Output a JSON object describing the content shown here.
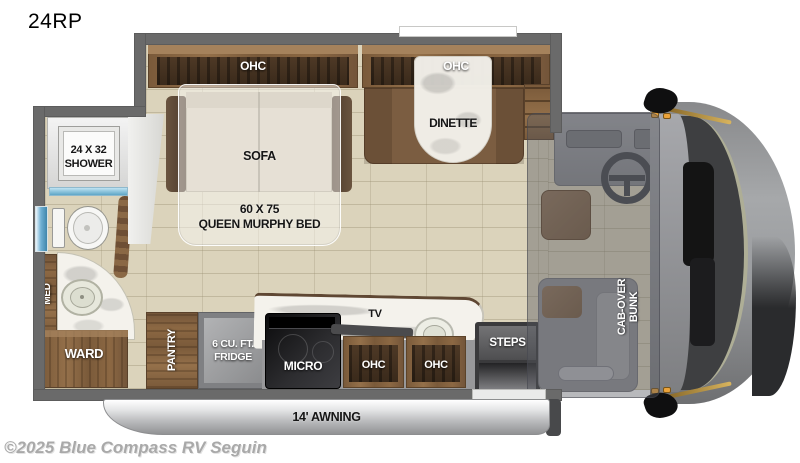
{
  "page": {
    "model": "24RP",
    "watermark": "©2025 Blue Compass RV Seguin"
  },
  "labels": {
    "shower_size": "24 X 32",
    "shower": "SHOWER",
    "med": "MED",
    "ward": "WARD",
    "pantry": "PANTRY",
    "fridge_size": "6 CU. FT.",
    "fridge": "FRIDGE",
    "micro": "MICRO",
    "tv": "TV",
    "ohc_top_left": "OHC",
    "ohc_top_right": "OHC",
    "ohc_kitchen_left": "OHC",
    "ohc_kitchen_right": "OHC",
    "sofa": "SOFA",
    "bed_size": "60 X 75",
    "bed": "QUEEN MURPHY BED",
    "dinette": "DINETTE",
    "steps": "STEPS",
    "bunk_line1": "CAB-OVER",
    "bunk_line2": "BUNK",
    "awning": "14' AWNING"
  },
  "colors": {
    "wall": "#6a6a6a",
    "floor_tile": "#dbd3bb",
    "wood": "#8a6845",
    "marble": "#f4f2ec",
    "accent_orange": "#e9a43c",
    "window_blue": "#7db9d8",
    "awning_silver": "#c8c9cb",
    "cab_overlay": "rgba(86,88,95,0.42)"
  }
}
